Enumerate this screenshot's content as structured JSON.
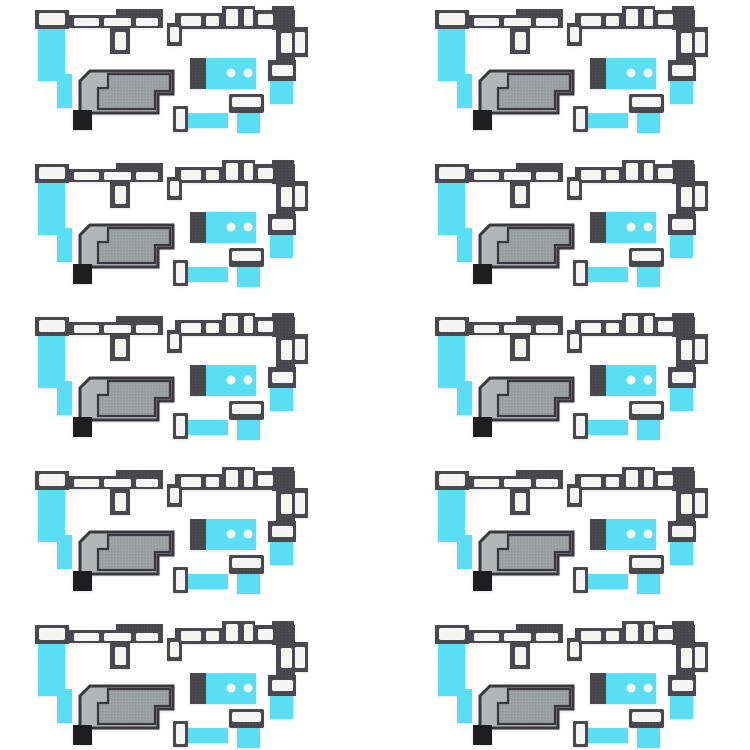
{
  "image": {
    "subject": "Ten identical sets of phone dust-proof mesh adhesive stickers arranged in a grid on a white background",
    "sets_total": 10
  },
  "grid": {
    "rows": 5,
    "columns": 2
  },
  "sticker_set": {
    "pieces": [
      {
        "name": "left-bracket-gasket",
        "description": "dark gray bracket strip with white slot windows, T-stem window and cyan adhesive tab hanging below"
      },
      {
        "name": "right-bracket-gasket",
        "description": "dark gray stepped bracket with white slot windows, descending right arm and cyan adhesive tab at lower end"
      },
      {
        "name": "mesh-panel",
        "description": "speckled gray mesh panel with dark border, stepped inner mesh region, black corner pad and cyan tab on left edge"
      },
      {
        "name": "perforated-tab",
        "description": "cyan rectangle with dark gray end band and two white holes"
      },
      {
        "name": "window-frame-pad",
        "description": "dark gray frame with white window and cyan adhesive tab below"
      },
      {
        "name": "small-tab",
        "description": "small white window pad with cyan strip extending to the right"
      }
    ]
  },
  "colors": {
    "background": "#ffffff",
    "cyan": "#5adef3",
    "charcoal": "#48484c",
    "slot-white": "#f5f5f3",
    "outline-dark": "#39393d",
    "mesh-gray": "#9da0a3",
    "panel-light-gray": "#b4b5b7",
    "foot-black": "#1e1e21"
  }
}
